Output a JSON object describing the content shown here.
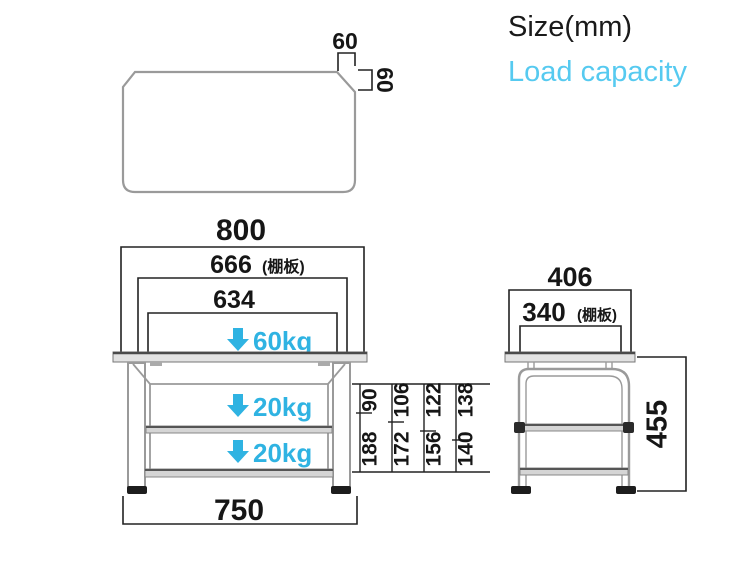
{
  "header": {
    "size_label": "Size(mm)",
    "load_capacity_label": "Load capacity"
  },
  "top_view": {
    "corner_width": "60",
    "corner_depth": "60"
  },
  "front_view": {
    "overall_width": "800",
    "shelf_width": "666",
    "shelf_width_note": "(棚板)",
    "inner_width": "634",
    "top_load": "60kg",
    "middle_load": "20kg",
    "bottom_load": "20kg",
    "leg_span": "750"
  },
  "shelf_positions": {
    "columns": [
      {
        "upper": "90",
        "lower": "188"
      },
      {
        "upper": "106",
        "lower": "172"
      },
      {
        "upper": "122",
        "lower": "156"
      },
      {
        "upper": "138",
        "lower": "140"
      }
    ]
  },
  "side_view": {
    "overall_depth": "406",
    "shelf_depth": "340",
    "shelf_depth_note": "(棚板)",
    "height": "455"
  },
  "colors": {
    "accent": "#2fb3e2",
    "header_accent": "#56caf0",
    "line": "#222222",
    "furniture": "#9a9a9a"
  }
}
